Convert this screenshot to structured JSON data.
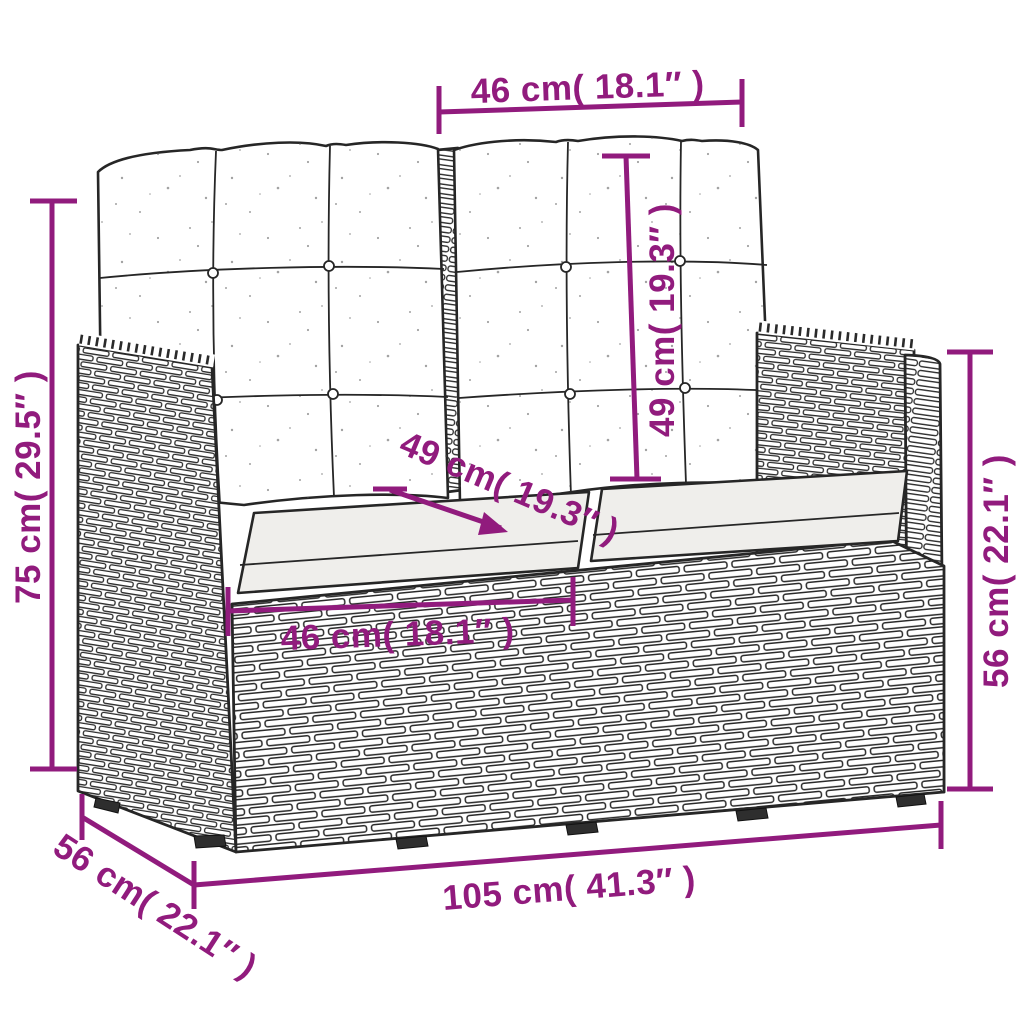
{
  "figure": {
    "subject": "garden-bench-with-cushions-dimension-diagram",
    "style": "line-drawing"
  },
  "colors": {
    "accent": "#911b7d",
    "ink": "#262626",
    "seat_cushion_fill": "#efeeeb",
    "background": "#ffffff"
  },
  "dimensions": {
    "top_width": "46 cm( 18.1″ )",
    "back_cushion_height": "49 cm( 19.3″ )",
    "seat_depth": "49 cm( 19.3″ )",
    "seat_width": "46 cm( 18.1″ )",
    "overall_height": "75 cm( 29.5″ )",
    "side_height": "56 cm( 22.1″ )",
    "overall_depth": "56 cm( 22.1″ )",
    "overall_width": "105 cm( 41.3″ )"
  }
}
